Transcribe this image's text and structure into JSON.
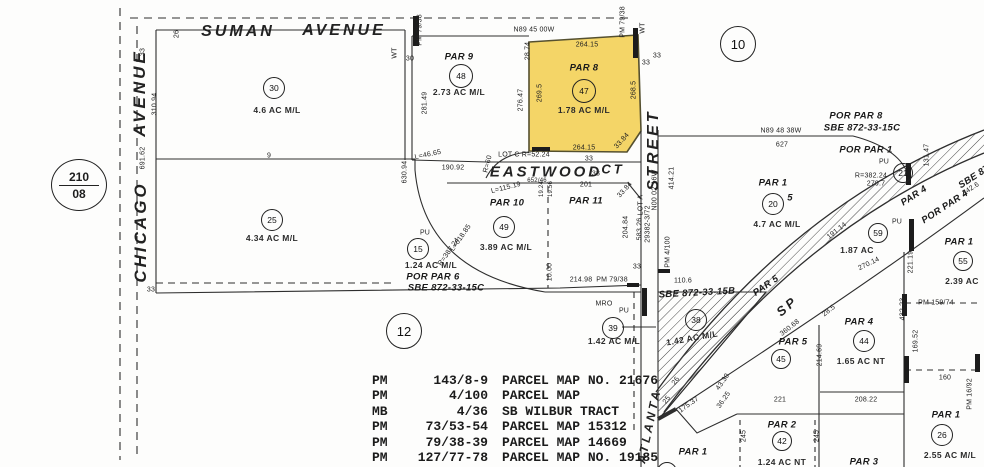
{
  "map": {
    "colors": {
      "ink": "#2a2a2a",
      "highlight": "#f4d567",
      "paper": "#fdfdfc"
    },
    "map_ref": {
      "book": "210",
      "page": "08"
    },
    "highlight_parcel": {
      "name": "PAR 8",
      "circle_number": "47",
      "acreage": "1.78 AC M/L"
    },
    "big_circles": [
      {
        "n": "10",
        "x": 737,
        "y": 43,
        "r": 17
      },
      {
        "n": "12",
        "x": 403,
        "y": 330,
        "r": 17
      }
    ],
    "circles": [
      {
        "n": "30",
        "x": 273,
        "y": 87,
        "r": 10
      },
      {
        "n": "48",
        "x": 460,
        "y": 75,
        "r": 11
      },
      {
        "n": "47",
        "x": 583,
        "y": 90,
        "r": 11
      },
      {
        "n": "25",
        "x": 271,
        "y": 219,
        "r": 10
      },
      {
        "n": "49",
        "x": 503,
        "y": 226,
        "r": 10
      },
      {
        "n": "15",
        "x": 417,
        "y": 248,
        "r": 10
      },
      {
        "n": "39",
        "x": 612,
        "y": 327,
        "r": 10
      },
      {
        "n": "38",
        "x": 695,
        "y": 319,
        "r": 10
      },
      {
        "n": "20",
        "x": 772,
        "y": 203,
        "r": 10
      },
      {
        "n": "21",
        "x": 902,
        "y": 172,
        "r": 9
      },
      {
        "n": "59",
        "x": 877,
        "y": 232,
        "r": 9
      },
      {
        "n": "55",
        "x": 962,
        "y": 260,
        "r": 9
      },
      {
        "n": "45",
        "x": 780,
        "y": 358,
        "r": 9
      },
      {
        "n": "44",
        "x": 863,
        "y": 340,
        "r": 10
      },
      {
        "n": "42",
        "x": 781,
        "y": 440,
        "r": 9
      },
      {
        "n": "26",
        "x": 941,
        "y": 434,
        "r": 10
      },
      {
        "n": "41",
        "x": 666,
        "y": 471,
        "r": 9
      }
    ],
    "labels": [
      {
        "t": "SUMAN",
        "x": 238,
        "y": 32,
        "s": 16,
        "c": "street"
      },
      {
        "t": "AVENUE",
        "x": 344,
        "y": 31,
        "s": 16,
        "c": "street"
      },
      {
        "t": "CHICAGO",
        "x": 141,
        "y": 232,
        "r": -90,
        "s": 17,
        "c": "street"
      },
      {
        "t": "AVENUE",
        "x": 140,
        "y": 93,
        "r": -90,
        "s": 17,
        "c": "street"
      },
      {
        "t": "EASTWOOD",
        "x": 546,
        "y": 172,
        "s": 15,
        "c": "street"
      },
      {
        "t": "CT",
        "x": 613,
        "y": 169,
        "s": 13,
        "c": "street"
      },
      {
        "t": "STREET",
        "x": 654,
        "y": 150,
        "r": -90,
        "s": 16,
        "c": "street"
      },
      {
        "t": "ATLANTA",
        "x": 649,
        "y": 426,
        "r": -78,
        "s": 12,
        "c": "street"
      },
      {
        "t": "SP",
        "x": 787,
        "y": 306,
        "r": -40,
        "s": 13,
        "c": "street"
      },
      {
        "t": "PAR 9",
        "x": 459,
        "y": 57,
        "c": "par"
      },
      {
        "t": "PAR 8",
        "x": 584,
        "y": 68,
        "c": "par"
      },
      {
        "t": "PAR 10",
        "x": 507,
        "y": 203,
        "c": "par"
      },
      {
        "t": "PAR 11",
        "x": 586,
        "y": 201,
        "c": "par"
      },
      {
        "t": "POR PAR 6",
        "x": 433,
        "y": 277,
        "c": "par"
      },
      {
        "t": "SBE 872-33-15C",
        "x": 446,
        "y": 288,
        "c": "par"
      },
      {
        "t": "POR PAR 8",
        "x": 856,
        "y": 116,
        "c": "par"
      },
      {
        "t": "SBE 872-33-15C",
        "x": 862,
        "y": 128,
        "c": "par"
      },
      {
        "t": "POR PAR 1",
        "x": 866,
        "y": 150,
        "c": "par"
      },
      {
        "t": "PAR 1",
        "x": 773,
        "y": 183,
        "c": "par"
      },
      {
        "t": "5",
        "x": 790,
        "y": 198,
        "c": "par"
      },
      {
        "t": "PAR 4",
        "x": 914,
        "y": 196,
        "r": -33,
        "c": "par"
      },
      {
        "t": "POR PAR 4",
        "x": 945,
        "y": 207,
        "r": -33,
        "c": "par"
      },
      {
        "t": "SBE 87",
        "x": 974,
        "y": 177,
        "r": -33,
        "c": "par"
      },
      {
        "t": "PAR 5",
        "x": 766,
        "y": 286,
        "r": -35,
        "c": "par"
      },
      {
        "t": "SBE 872-33-15B",
        "x": 697,
        "y": 293,
        "r": -3,
        "c": "par"
      },
      {
        "t": "PAR 5",
        "x": 793,
        "y": 342,
        "c": "par"
      },
      {
        "t": "PAR 1",
        "x": 959,
        "y": 242,
        "c": "par"
      },
      {
        "t": "PAR 4",
        "x": 859,
        "y": 322,
        "c": "par"
      },
      {
        "t": "PAR 1",
        "x": 946,
        "y": 415,
        "c": "par"
      },
      {
        "t": "PAR 3",
        "x": 864,
        "y": 462,
        "c": "par"
      },
      {
        "t": "PAR 2",
        "x": 782,
        "y": 425,
        "c": "par"
      },
      {
        "t": "PAR 1",
        "x": 693,
        "y": 452,
        "c": "par"
      },
      {
        "t": "4.6 AC M/L",
        "x": 277,
        "y": 110,
        "c": "ac"
      },
      {
        "t": "2.73 AC M/L",
        "x": 459,
        "y": 92,
        "c": "ac"
      },
      {
        "t": "1.78 AC M/L",
        "x": 584,
        "y": 110,
        "c": "ac"
      },
      {
        "t": "4.34 AC M/L",
        "x": 272,
        "y": 238,
        "c": "ac"
      },
      {
        "t": "3.89 AC M/L",
        "x": 506,
        "y": 247,
        "c": "ac"
      },
      {
        "t": "1.24 AC M/L",
        "x": 431,
        "y": 265,
        "c": "ac"
      },
      {
        "t": "1.42 AC M/L",
        "x": 614,
        "y": 341,
        "c": "ac"
      },
      {
        "t": "1.42 AC M/L",
        "x": 692,
        "y": 338,
        "r": -10,
        "c": "ac"
      },
      {
        "t": "4.7 AC M/L",
        "x": 777,
        "y": 224,
        "c": "ac"
      },
      {
        "t": "1.87 AC",
        "x": 857,
        "y": 250,
        "c": "ac"
      },
      {
        "t": "2.39 AC",
        "x": 962,
        "y": 281,
        "c": "ac"
      },
      {
        "t": "1.65 AC NT",
        "x": 861,
        "y": 361,
        "c": "ac"
      },
      {
        "t": "2.55 AC M/L",
        "x": 950,
        "y": 455,
        "c": "ac"
      },
      {
        "t": "1.24 AC NT",
        "x": 782,
        "y": 462,
        "c": "ac"
      },
      {
        "t": "26",
        "x": 177,
        "y": 34,
        "r": -90
      },
      {
        "t": "33",
        "x": 143,
        "y": 52,
        "r": -90
      },
      {
        "t": "310.94",
        "x": 155,
        "y": 104,
        "r": -90
      },
      {
        "t": "691.62",
        "x": 143,
        "y": 158,
        "r": -90
      },
      {
        "t": "33",
        "x": 151,
        "y": 290
      },
      {
        "t": "9",
        "x": 269,
        "y": 156
      },
      {
        "t": "PM 79/38",
        "x": 420,
        "y": 30,
        "r": -90
      },
      {
        "t": "WT",
        "x": 395,
        "y": 53,
        "r": -90
      },
      {
        "t": "30",
        "x": 410,
        "y": 59
      },
      {
        "t": "281.49",
        "x": 425,
        "y": 103,
        "r": -90
      },
      {
        "t": "276.47",
        "x": 521,
        "y": 100,
        "r": -90
      },
      {
        "t": "28.74",
        "x": 528,
        "y": 51,
        "r": -90
      },
      {
        "t": "L=46.65",
        "x": 428,
        "y": 155,
        "r": -12
      },
      {
        "t": "N89 45 00W",
        "x": 534,
        "y": 30
      },
      {
        "t": "264.15",
        "x": 587,
        "y": 45
      },
      {
        "t": "269.5",
        "x": 540,
        "y": 93,
        "r": -90
      },
      {
        "t": "268.5",
        "x": 634,
        "y": 90,
        "r": -90
      },
      {
        "t": "264.15",
        "x": 584,
        "y": 148
      },
      {
        "t": "33.84",
        "x": 622,
        "y": 141,
        "r": -48
      },
      {
        "t": "PM 79/38",
        "x": 623,
        "y": 22,
        "r": -90
      },
      {
        "t": "WT",
        "x": 643,
        "y": 28,
        "r": -90
      },
      {
        "t": "33",
        "x": 646,
        "y": 63
      },
      {
        "t": "33",
        "x": 657,
        "y": 56
      },
      {
        "t": "N89 48 38W",
        "x": 781,
        "y": 131
      },
      {
        "t": "627",
        "x": 782,
        "y": 145
      },
      {
        "t": "PU",
        "x": 884,
        "y": 162
      },
      {
        "t": "R=382.24",
        "x": 871,
        "y": 176
      },
      {
        "t": "279.7",
        "x": 876,
        "y": 184
      },
      {
        "t": "131.47",
        "x": 927,
        "y": 155,
        "r": -90
      },
      {
        "t": "342.6",
        "x": 971,
        "y": 189,
        "r": -33
      },
      {
        "t": "191.14",
        "x": 837,
        "y": 231,
        "r": -38
      },
      {
        "t": "414.21",
        "x": 672,
        "y": 178,
        "r": -90
      },
      {
        "t": "PM 4/100",
        "x": 668,
        "y": 252,
        "r": -90
      },
      {
        "t": "N00 02 16W",
        "x": 655,
        "y": 190,
        "r": -90
      },
      {
        "t": "29382-3/72",
        "x": 648,
        "y": 224,
        "r": -90
      },
      {
        "t": "583.26",
        "x": 640,
        "y": 229,
        "r": -90
      },
      {
        "t": "LOT A",
        "x": 641,
        "y": 205,
        "r": -90
      },
      {
        "t": "204.84",
        "x": 626,
        "y": 227,
        "r": -90
      },
      {
        "t": "33",
        "x": 637,
        "y": 267
      },
      {
        "t": "33.84",
        "x": 625,
        "y": 190,
        "r": -48
      },
      {
        "t": "33",
        "x": 596,
        "y": 174
      },
      {
        "t": "33",
        "x": 589,
        "y": 159
      },
      {
        "t": "LOT C  R=52.24",
        "x": 524,
        "y": 155
      },
      {
        "t": "R=60",
        "x": 488,
        "y": 164,
        "r": -75
      },
      {
        "t": "652/46",
        "x": 537,
        "y": 181,
        "s": 6
      },
      {
        "t": "L=115.19",
        "x": 506,
        "y": 188,
        "r": -14
      },
      {
        "t": "190.92",
        "x": 453,
        "y": 168
      },
      {
        "t": "630.94",
        "x": 405,
        "y": 172,
        "r": -90
      },
      {
        "t": "19.24",
        "x": 542,
        "y": 189,
        "r": -90,
        "s": 6
      },
      {
        "t": "19.56",
        "x": 551,
        "y": 189,
        "r": -90,
        "s": 6
      },
      {
        "t": "201",
        "x": 586,
        "y": 185
      },
      {
        "t": "PU",
        "x": 425,
        "y": 233
      },
      {
        "t": "L=618.85",
        "x": 461,
        "y": 238,
        "r": -55
      },
      {
        "t": "R=387.24",
        "x": 449,
        "y": 252,
        "r": -55
      },
      {
        "t": "10.00",
        "x": 550,
        "y": 272,
        "r": -90
      },
      {
        "t": "214.98",
        "x": 581,
        "y": 280
      },
      {
        "t": "PM 79/38",
        "x": 612,
        "y": 280
      },
      {
        "t": "110.6",
        "x": 683,
        "y": 281
      },
      {
        "t": "MRO",
        "x": 604,
        "y": 304
      },
      {
        "t": "PU",
        "x": 624,
        "y": 311
      },
      {
        "t": "360.68",
        "x": 790,
        "y": 328,
        "r": -38
      },
      {
        "t": "214.69",
        "x": 820,
        "y": 355,
        "r": -90
      },
      {
        "t": "28.5",
        "x": 829,
        "y": 311,
        "r": -38
      },
      {
        "t": "270.14",
        "x": 869,
        "y": 264,
        "r": -26
      },
      {
        "t": "PU",
        "x": 897,
        "y": 222
      },
      {
        "t": "221.19",
        "x": 911,
        "y": 262,
        "r": -90
      },
      {
        "t": "432.23",
        "x": 903,
        "y": 309,
        "r": -90
      },
      {
        "t": "PM 159/74",
        "x": 936,
        "y": 303
      },
      {
        "t": "208.22",
        "x": 866,
        "y": 400
      },
      {
        "t": "160",
        "x": 945,
        "y": 378
      },
      {
        "t": "PM 16/92",
        "x": 970,
        "y": 394,
        "r": -90
      },
      {
        "t": "169.52",
        "x": 916,
        "y": 341,
        "r": -90
      },
      {
        "t": "245",
        "x": 744,
        "y": 436,
        "r": -90
      },
      {
        "t": "245",
        "x": 817,
        "y": 436,
        "r": -90
      },
      {
        "t": "221",
        "x": 780,
        "y": 400
      },
      {
        "t": "175.37",
        "x": 689,
        "y": 405,
        "r": -35
      },
      {
        "t": "36.25",
        "x": 724,
        "y": 400,
        "r": -55
      },
      {
        "t": "43.30",
        "x": 723,
        "y": 382,
        "r": -55
      },
      {
        "t": "25",
        "x": 667,
        "y": 400,
        "r": -55
      },
      {
        "t": "26",
        "x": 676,
        "y": 381,
        "r": -55
      }
    ]
  },
  "reference_list": {
    "rows": [
      {
        "book": "PM",
        "page": "143/8-9",
        "desc": "PARCEL MAP NO. 21676"
      },
      {
        "book": "PM",
        "page": "4/100",
        "desc": "PARCEL MAP"
      },
      {
        "book": "MB",
        "page": "4/36",
        "desc": "SB WILBUR TRACT"
      },
      {
        "book": "PM",
        "page": "73/53-54",
        "desc": "PARCEL MAP 15312"
      },
      {
        "book": "PM",
        "page": "79/38-39",
        "desc": "PARCEL MAP 14669"
      },
      {
        "book": "PM",
        "page": "127/77-78",
        "desc": "PARCEL MAP NO. 19185"
      }
    ]
  }
}
